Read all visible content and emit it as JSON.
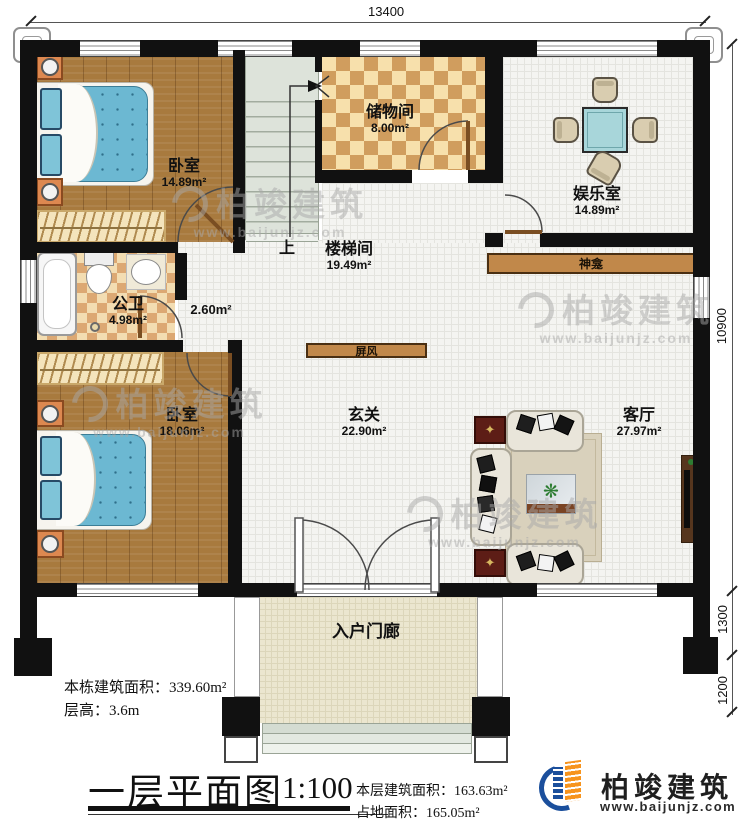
{
  "dimensions": {
    "top": "13400",
    "right_main": "10900",
    "right_mid": "1300",
    "right_bottom": "1200"
  },
  "rooms": {
    "bedroom1": {
      "name": "卧室",
      "area": "14.89m²"
    },
    "storage": {
      "name": "储物间",
      "area": "8.00m²"
    },
    "entertainment": {
      "name": "娱乐室",
      "area": "14.89m²"
    },
    "stairwell": {
      "name": "楼梯间",
      "area": "19.49m²"
    },
    "bathroom": {
      "name": "公卫",
      "area": "4.98m²"
    },
    "hallway": {
      "area": "2.60m²"
    },
    "bedroom2": {
      "name": "卧室",
      "area": "18.06m²"
    },
    "foyer": {
      "name": "玄关",
      "area": "22.90m²"
    },
    "living": {
      "name": "客厅",
      "area": "27.97m²"
    },
    "porch": {
      "name": "入户门廊"
    }
  },
  "labels": {
    "up": "上",
    "shrine": "神龛",
    "screen": "屏风"
  },
  "footer": {
    "building_total_label": "本栋建筑面积：",
    "building_total_value": "339.60m²",
    "floor_height_label": "层高：",
    "floor_height_value": "3.6m",
    "title": "一层平面图",
    "scale": "1:100",
    "floor_area_label": "本层建筑面积：",
    "floor_area_value": "163.63m²",
    "footprint_label": "占地面积：",
    "footprint_value": "165.05m²"
  },
  "brand": {
    "name": "柏竣建筑",
    "url": "www.baijunjz.com"
  },
  "watermark": {
    "name": "柏竣建筑",
    "url": "www.baijunjz.com"
  },
  "colors": {
    "wall": "#111111",
    "wood_floor": "#a87a3e",
    "tile_floor": "#f4f4f1",
    "checker": "#dca873",
    "wood_bar": "#c1884a",
    "stairs": "#dde3da",
    "porch": "#ebe6cf",
    "bed": "#6cb8d2",
    "brand_blue": "#1b4f9c",
    "brand_orange": "#f7941d"
  }
}
